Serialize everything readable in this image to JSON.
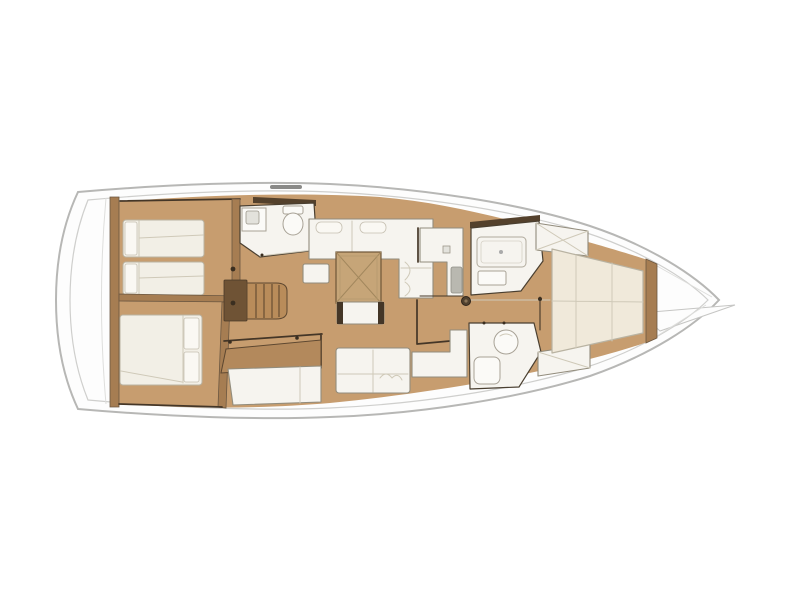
{
  "diagram": {
    "kind": "sailing-yacht-interior-floor-plan",
    "orientation": "bow-right",
    "rooms": [
      {
        "id": "aft-port-cabin",
        "features": [
          "twin-berths",
          "pillows"
        ]
      },
      {
        "id": "aft-starboard-cabin",
        "features": [
          "double-berth",
          "pillows"
        ]
      },
      {
        "id": "aft-head",
        "features": [
          "sink",
          "toilet"
        ]
      },
      {
        "id": "companionway",
        "features": [
          "stairs",
          "landing"
        ]
      },
      {
        "id": "salon",
        "features": [
          "l-settee",
          "square-table",
          "ottoman",
          "sofa"
        ]
      },
      {
        "id": "nav-station",
        "features": [
          "chart-desk",
          "cabinet"
        ]
      },
      {
        "id": "galley",
        "features": [
          "upper-counter",
          "lower-counter",
          "sink"
        ]
      },
      {
        "id": "forward-shower",
        "features": [
          "shower-pan",
          "bench"
        ]
      },
      {
        "id": "forward-head",
        "features": [
          "round-sink",
          "toilet"
        ]
      },
      {
        "id": "forward-cabin",
        "features": [
          "v-berth",
          "lockers"
        ]
      },
      {
        "id": "forepeak",
        "features": [
          "anchor-locker"
        ]
      }
    ]
  },
  "colors": {
    "background": "#ffffff",
    "hull_fill": "#fdfdfd",
    "hull_stroke": "#b7b7b5",
    "deck_line": "#cfcfcd",
    "floor": "#c79d6f",
    "bulkhead": "#a67d52",
    "wall_dark": "#443627",
    "stairs": "#b98c5a",
    "stairs_dark": "#7c5e3c",
    "landing": "#6f5335",
    "desk": "#b3895c",
    "table": "#c6a578",
    "table_line": "#a2875d",
    "room_white": "#f6f4ef",
    "furniture_stroke": "#928c7c",
    "mattress": "#f2efe6",
    "mattress_stroke": "#b9b3a2",
    "pillow": "#faf8f3",
    "bed_cream": "#f0e9da",
    "seam": "#cfc9b8",
    "fixture_fill": "#fbfaf7",
    "fixture_stroke": "#a8a296",
    "sink_grey": "#b9b8b0",
    "hardware": "#3a2e20"
  }
}
